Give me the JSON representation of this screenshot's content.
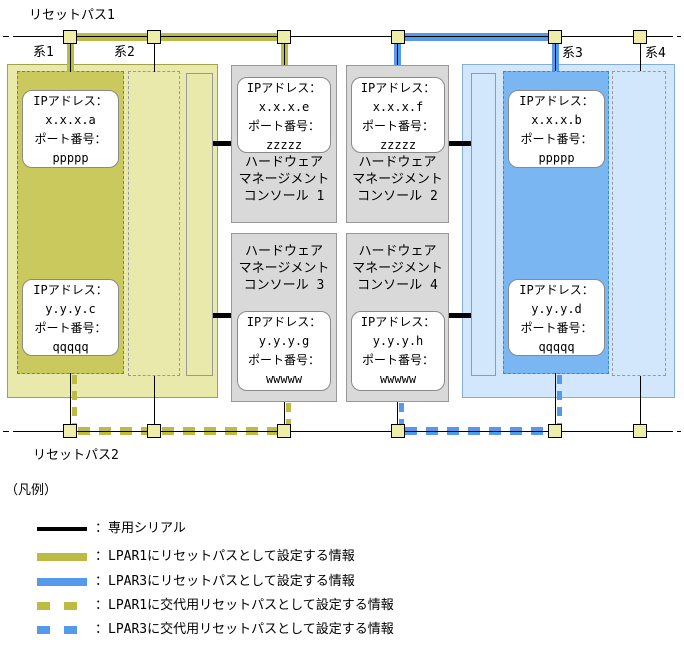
{
  "page": {
    "top_bus_label": "リセットパス1",
    "bottom_bus_label": "リセットパス2"
  },
  "system_labels": {
    "s1": "系1",
    "s2": "系2",
    "s3": "系3",
    "s4": "系4"
  },
  "ms0001": {
    "name": "MS0001",
    "lpar1_label": "LPAR1",
    "lpar2_label": "LPAR2",
    "sp_label": "SP",
    "lpar1_ip_top": {
      "l1": "IPアドレス：",
      "l2": "x.x.x.a",
      "l3": "ポート番号：",
      "l4": "ppppp"
    },
    "lpar1_ip_bottom": {
      "l1": "IPアドレス：",
      "l2": "y.y.y.c",
      "l3": "ポート番号：",
      "l4": "qqqqq"
    }
  },
  "ms0002": {
    "name": "MS0002",
    "sp_label": "SP",
    "lpar3_label": "LPAR3",
    "lpar4_label": "LPAR4",
    "lpar3_ip_top": {
      "l1": "IPアドレス：",
      "l2": "x.x.x.b",
      "l3": "ポート番号：",
      "l4": "ppppp"
    },
    "lpar3_ip_bottom": {
      "l1": "IPアドレス：",
      "l2": "y.y.y.d",
      "l3": "ポート番号：",
      "l4": "qqqqq"
    }
  },
  "consoles": {
    "hmc1": {
      "line1": "ハードウェア",
      "line2": "マネージメント",
      "line3": "コンソール 1",
      "ip": {
        "l1": "IPアドレス：",
        "l2": "x.x.x.e",
        "l3": "ポート番号：",
        "l4": "zzzzz"
      }
    },
    "hmc2": {
      "line1": "ハードウェア",
      "line2": "マネージメント",
      "line3": "コンソール 2",
      "ip": {
        "l1": "IPアドレス：",
        "l2": "x.x.x.f",
        "l3": "ポート番号：",
        "l4": "zzzzz"
      }
    },
    "hmc3": {
      "line1": "ハードウェア",
      "line2": "マネージメント",
      "line3": "コンソール 3",
      "ip": {
        "l1": "IPアドレス：",
        "l2": "y.y.y.g",
        "l3": "ポート番号：",
        "l4": "wwwww"
      }
    },
    "hmc4": {
      "line1": "ハードウェア",
      "line2": "マネージメント",
      "line3": "コンソール 4",
      "ip": {
        "l1": "IPアドレス：",
        "l2": "y.y.y.h",
        "l3": "ポート番号：",
        "l4": "wwwww"
      }
    }
  },
  "legend": {
    "title": "（凡例）",
    "items": [
      {
        "style": "solid-black",
        "label": "：専用シリアル"
      },
      {
        "style": "solid-yellow",
        "label": "：LPAR1にリセットパスとして設定する情報"
      },
      {
        "style": "solid-blue",
        "label": "：LPAR3にリセットパスとして設定する情報"
      },
      {
        "style": "dashed-yellow",
        "label": "：LPAR1に交代用リセットパスとして設定する情報"
      },
      {
        "style": "dashed-blue",
        "label": "：LPAR3に交代用リセットパスとして設定する情報"
      }
    ]
  },
  "colors": {
    "lpar1_path": "#bcbc44",
    "lpar3_path": "#5599ea",
    "lpar1_fill": "#c9c95e",
    "lpar3_fill": "#79b6f2",
    "ms0001_fill": "#e9e9ab",
    "ms0002_fill": "#d2e7fb",
    "console_fill": "#d9d9d9",
    "node_fill": "#eeeeaa",
    "serial": "#000000"
  }
}
